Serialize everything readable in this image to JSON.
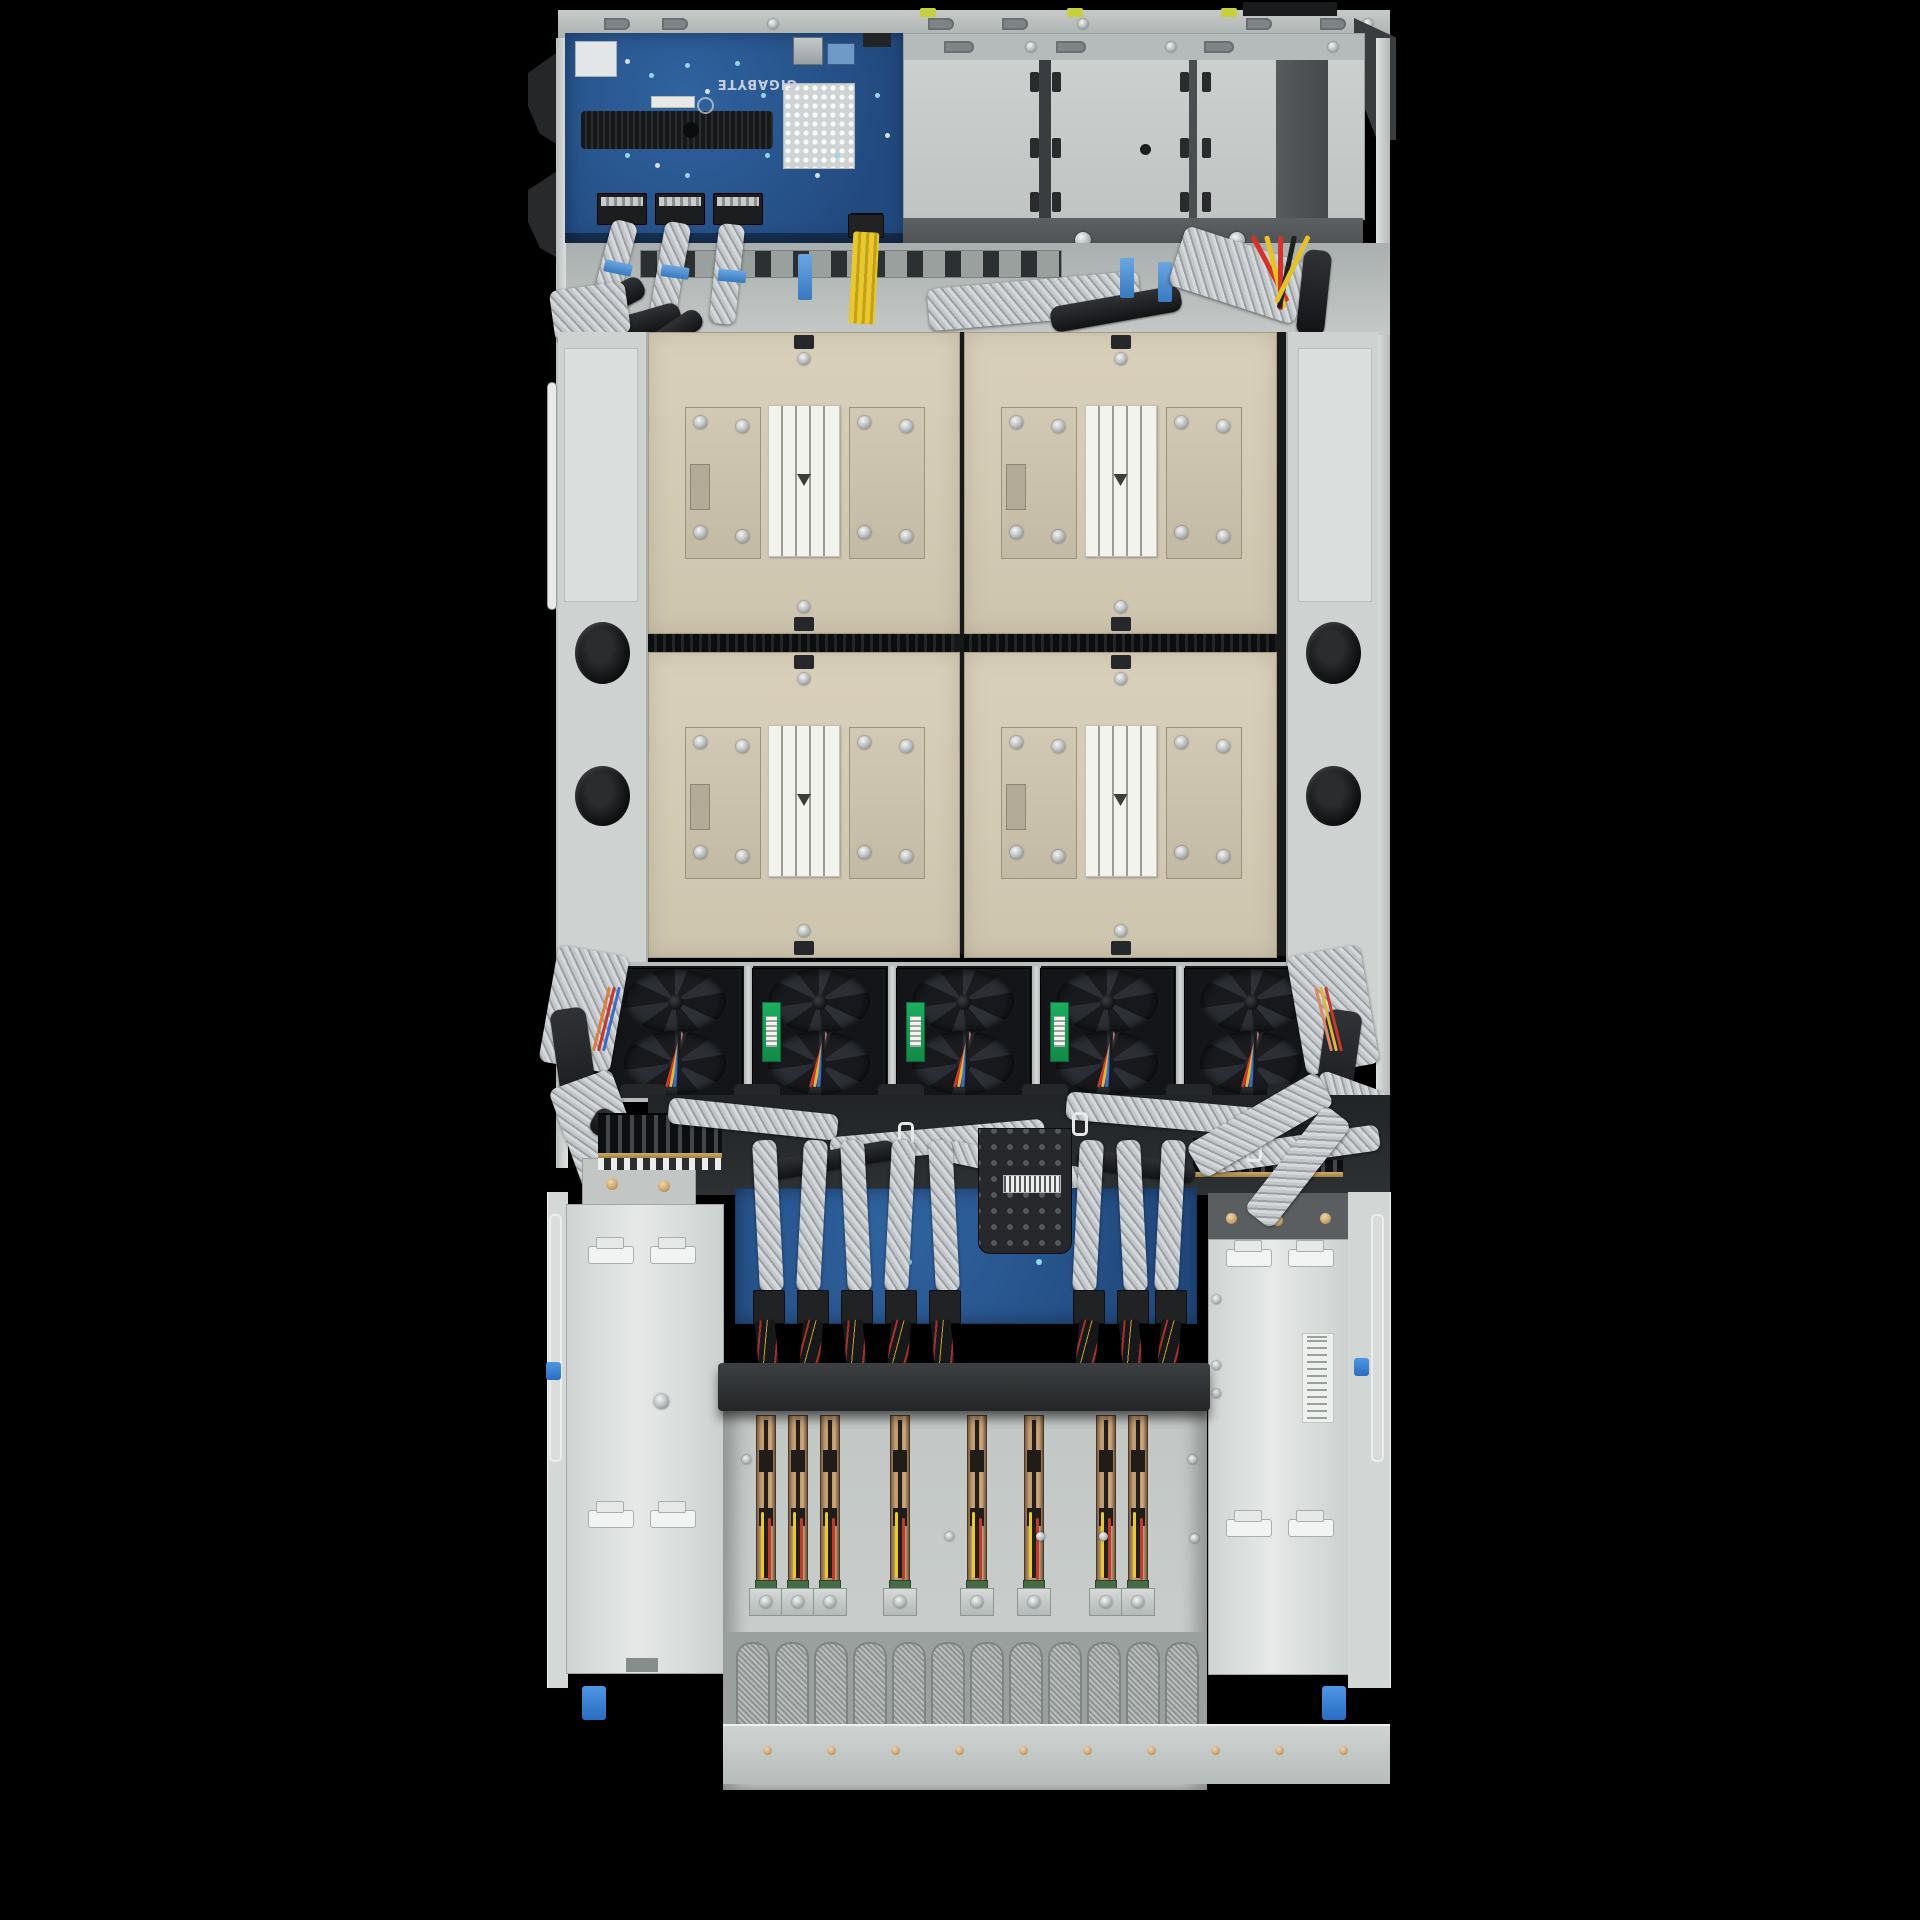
{
  "scene": {
    "description": "Top-down interior photograph of a 4U rackmount server chassis on a black background",
    "visible_text": [
      "GIGABYTE"
    ]
  },
  "brand": {
    "logo_text": "GIGABYTE"
  },
  "palette": {
    "background": "#000000",
    "chassis_metal": "#c8cdcb",
    "pcb_blue": "#2a5a9e",
    "heatsink_beige": "#d4cbb6",
    "fan_black": "#17191c",
    "fan_label_green": "#18a355",
    "cable_braid_silver": "#c4c8ca",
    "cable_sleeve_black": "#1d1f22",
    "power_cable_yellow": "#e2c22d",
    "wire_red": "#c23a2c",
    "tie_blue": "#4a90d9",
    "riser_copper": "#c29a6e"
  },
  "components": {
    "front_io_board": {
      "brand_mark": "GIGABYTE",
      "sas_connectors": 3,
      "pin_heatsinks": 1
    },
    "drive_cage": {
      "bays": 3
    },
    "cpu_heatsinks": {
      "count": 4,
      "rows": 2,
      "columns": 2
    },
    "fans": {
      "count": 5,
      "green_label_positions": [
        2,
        3,
        4
      ]
    },
    "midplane": {
      "cable_bundles": 8,
      "perforated_bracket": 1
    },
    "power_supplies": {
      "count": 2,
      "clips_per_psu": 4
    },
    "riser_cards": {
      "count": 8,
      "grouping": [
        3,
        1,
        1,
        1,
        2
      ]
    },
    "vent_slots": {
      "count": 12
    },
    "service_holes_per_rail": 2,
    "fan_wire_colors": [
      "#c8392c",
      "#e0b53a",
      "#3a6cc8",
      "#191a1c"
    ]
  }
}
